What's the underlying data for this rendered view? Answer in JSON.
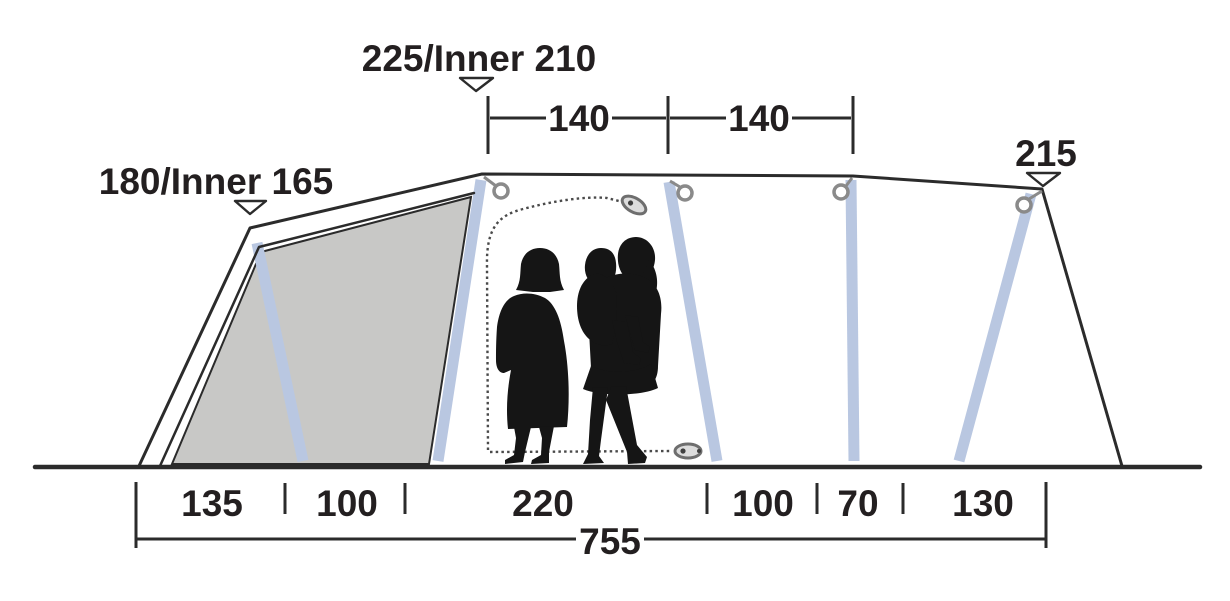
{
  "figure": {
    "height_labels": {
      "left": "180/Inner 165",
      "center": "225/Inner 210",
      "right": "215"
    },
    "top_widths": [
      "140",
      "140"
    ],
    "bottom_segments": [
      "135",
      "100",
      "220",
      "100",
      "70",
      "130"
    ],
    "total_width": "755",
    "colors": {
      "outline": "#2b2b2b",
      "text": "#231f20",
      "pole": "#b9c7e1",
      "panel": "#c8c8c6",
      "hardware": "#8a8a8a",
      "zipper": "#4a4a4a",
      "silhouette": "#151515"
    }
  }
}
